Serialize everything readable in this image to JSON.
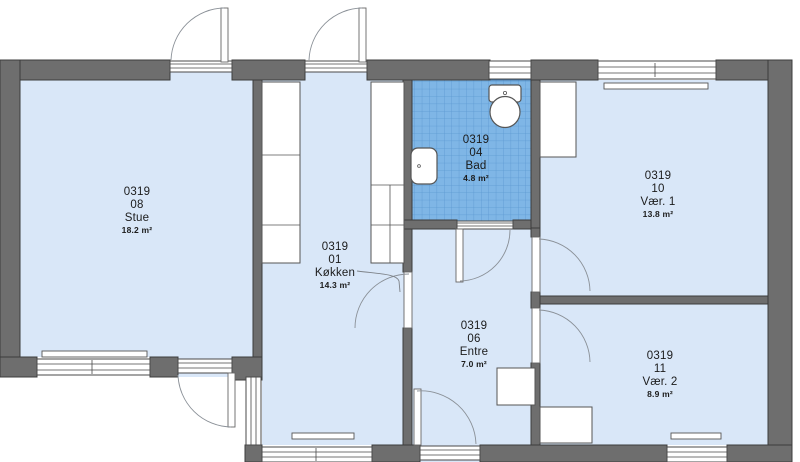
{
  "plan": {
    "rooms": [
      {
        "id": "0319",
        "number": "08",
        "name": "Stue",
        "area": "18.2 m²"
      },
      {
        "id": "0319",
        "number": "01",
        "name": "Køkken",
        "area": "14.3 m²"
      },
      {
        "id": "0319",
        "number": "04",
        "name": "Bad",
        "area": "4.8 m²"
      },
      {
        "id": "0319",
        "number": "10",
        "name": "Vær. 1",
        "area": "13.8 m²"
      },
      {
        "id": "0319",
        "number": "06",
        "name": "Entre",
        "area": "7.0 m²"
      },
      {
        "id": "0319",
        "number": "11",
        "name": "Vær. 2",
        "area": "8.9 m²"
      }
    ],
    "colors": {
      "wall": "#6e6e6e",
      "floor": "#d9e7f8",
      "tile": "#7fb6e6",
      "tile_grid": "#5c99d1",
      "fixture": "#ffffff",
      "outline": "#3c3c3c",
      "door_arc": "#8a9097",
      "label_text": "#1b1b1b"
    }
  }
}
